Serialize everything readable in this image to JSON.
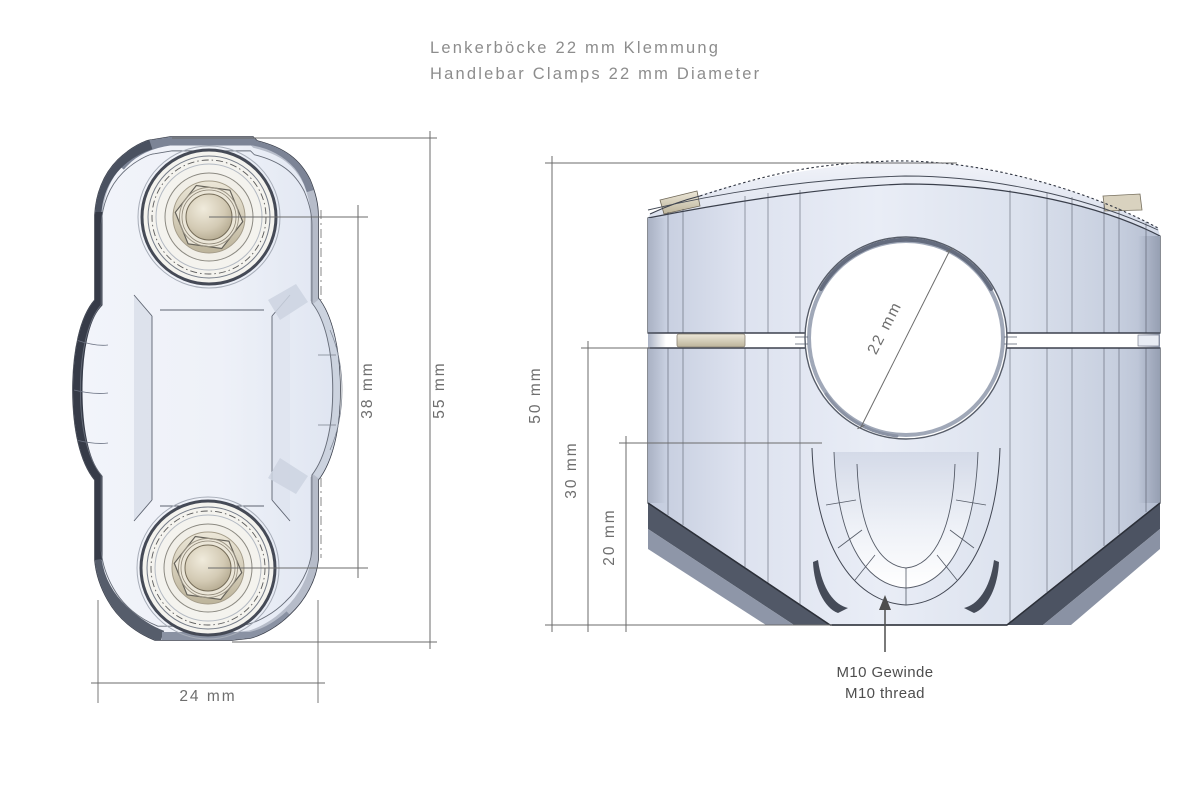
{
  "title": {
    "line_de": "Lenkerböcke 22 mm Klemmung",
    "line_en": "Handlebar Clamps 22 mm Diameter"
  },
  "top_view": {
    "dimensions": {
      "bolt_spacing": "38 mm",
      "overall_length": "55 mm",
      "overall_width": "24 mm"
    }
  },
  "front_view": {
    "dimensions": {
      "overall_height": "50 mm",
      "lower_clamp_height": "30 mm",
      "base_to_bore": "20 mm",
      "bore_diameter": "22 mm"
    },
    "thread_note": {
      "line_de": "M10 Gewinde",
      "line_en": "M10 thread"
    }
  },
  "colors": {
    "background": "#ffffff",
    "body_light": "#e9edf6",
    "body_mid": "#c9d1e1",
    "edge_dark": "#3a3f4b",
    "shadow_dark": "#3d4350",
    "bolt_beige": "#d5cdba",
    "dimension_gray": "#6b6b6b",
    "title_gray": "#8d8d8d"
  }
}
